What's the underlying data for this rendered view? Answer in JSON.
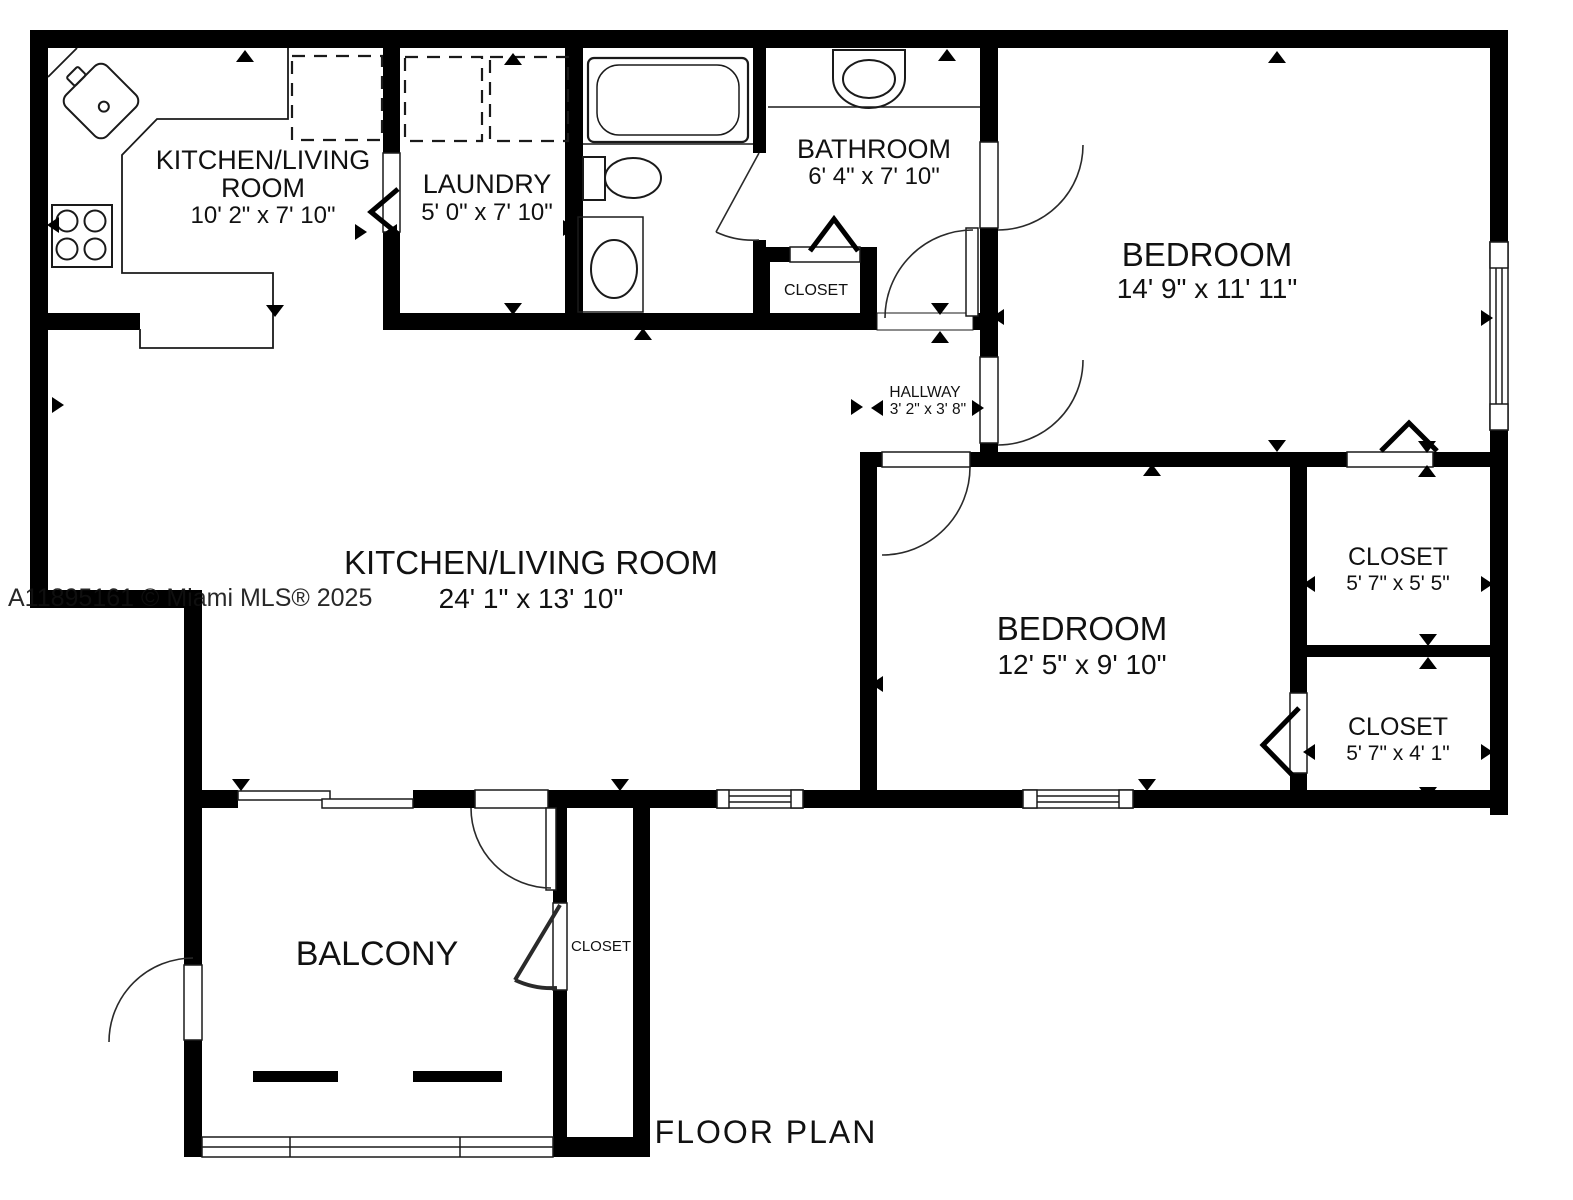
{
  "title": "FLOOR PLAN",
  "watermark": "A11895161 © Miami MLS® 2025",
  "colors": {
    "wall": "#000000",
    "line": "#1a1a1a",
    "background": "#ffffff",
    "watermark": "#9b9b9b"
  },
  "rooms": {
    "kitchen_nook": {
      "line1": "KITCHEN/LIVING",
      "line2": "ROOM",
      "dims": "10' 2\" x 7' 10\""
    },
    "laundry": {
      "name": "LAUNDRY",
      "dims": "5' 0\" x 7' 10\""
    },
    "bathroom": {
      "name": "BATHROOM",
      "dims": "6' 4\" x 7' 10\""
    },
    "bathroom_closet": {
      "name": "CLOSET"
    },
    "hallway": {
      "name": "HALLWAY",
      "dims": "3' 2\" x 3' 8\""
    },
    "bedroom_1": {
      "name": "BEDROOM",
      "dims": "14' 9\" x 11' 11\""
    },
    "living_room": {
      "name": "KITCHEN/LIVING ROOM",
      "dims": "24' 1\" x 13' 10\""
    },
    "bedroom_2": {
      "name": "BEDROOM",
      "dims": "12' 5\" x 9' 10\""
    },
    "closet_1": {
      "name": "CLOSET",
      "dims": "5' 7\" x 5' 5\""
    },
    "closet_2": {
      "name": "CLOSET",
      "dims": "5' 7\" x 4' 1\""
    },
    "balcony": {
      "name": "BALCONY"
    },
    "balcony_closet": {
      "name": "CLOSET"
    }
  }
}
